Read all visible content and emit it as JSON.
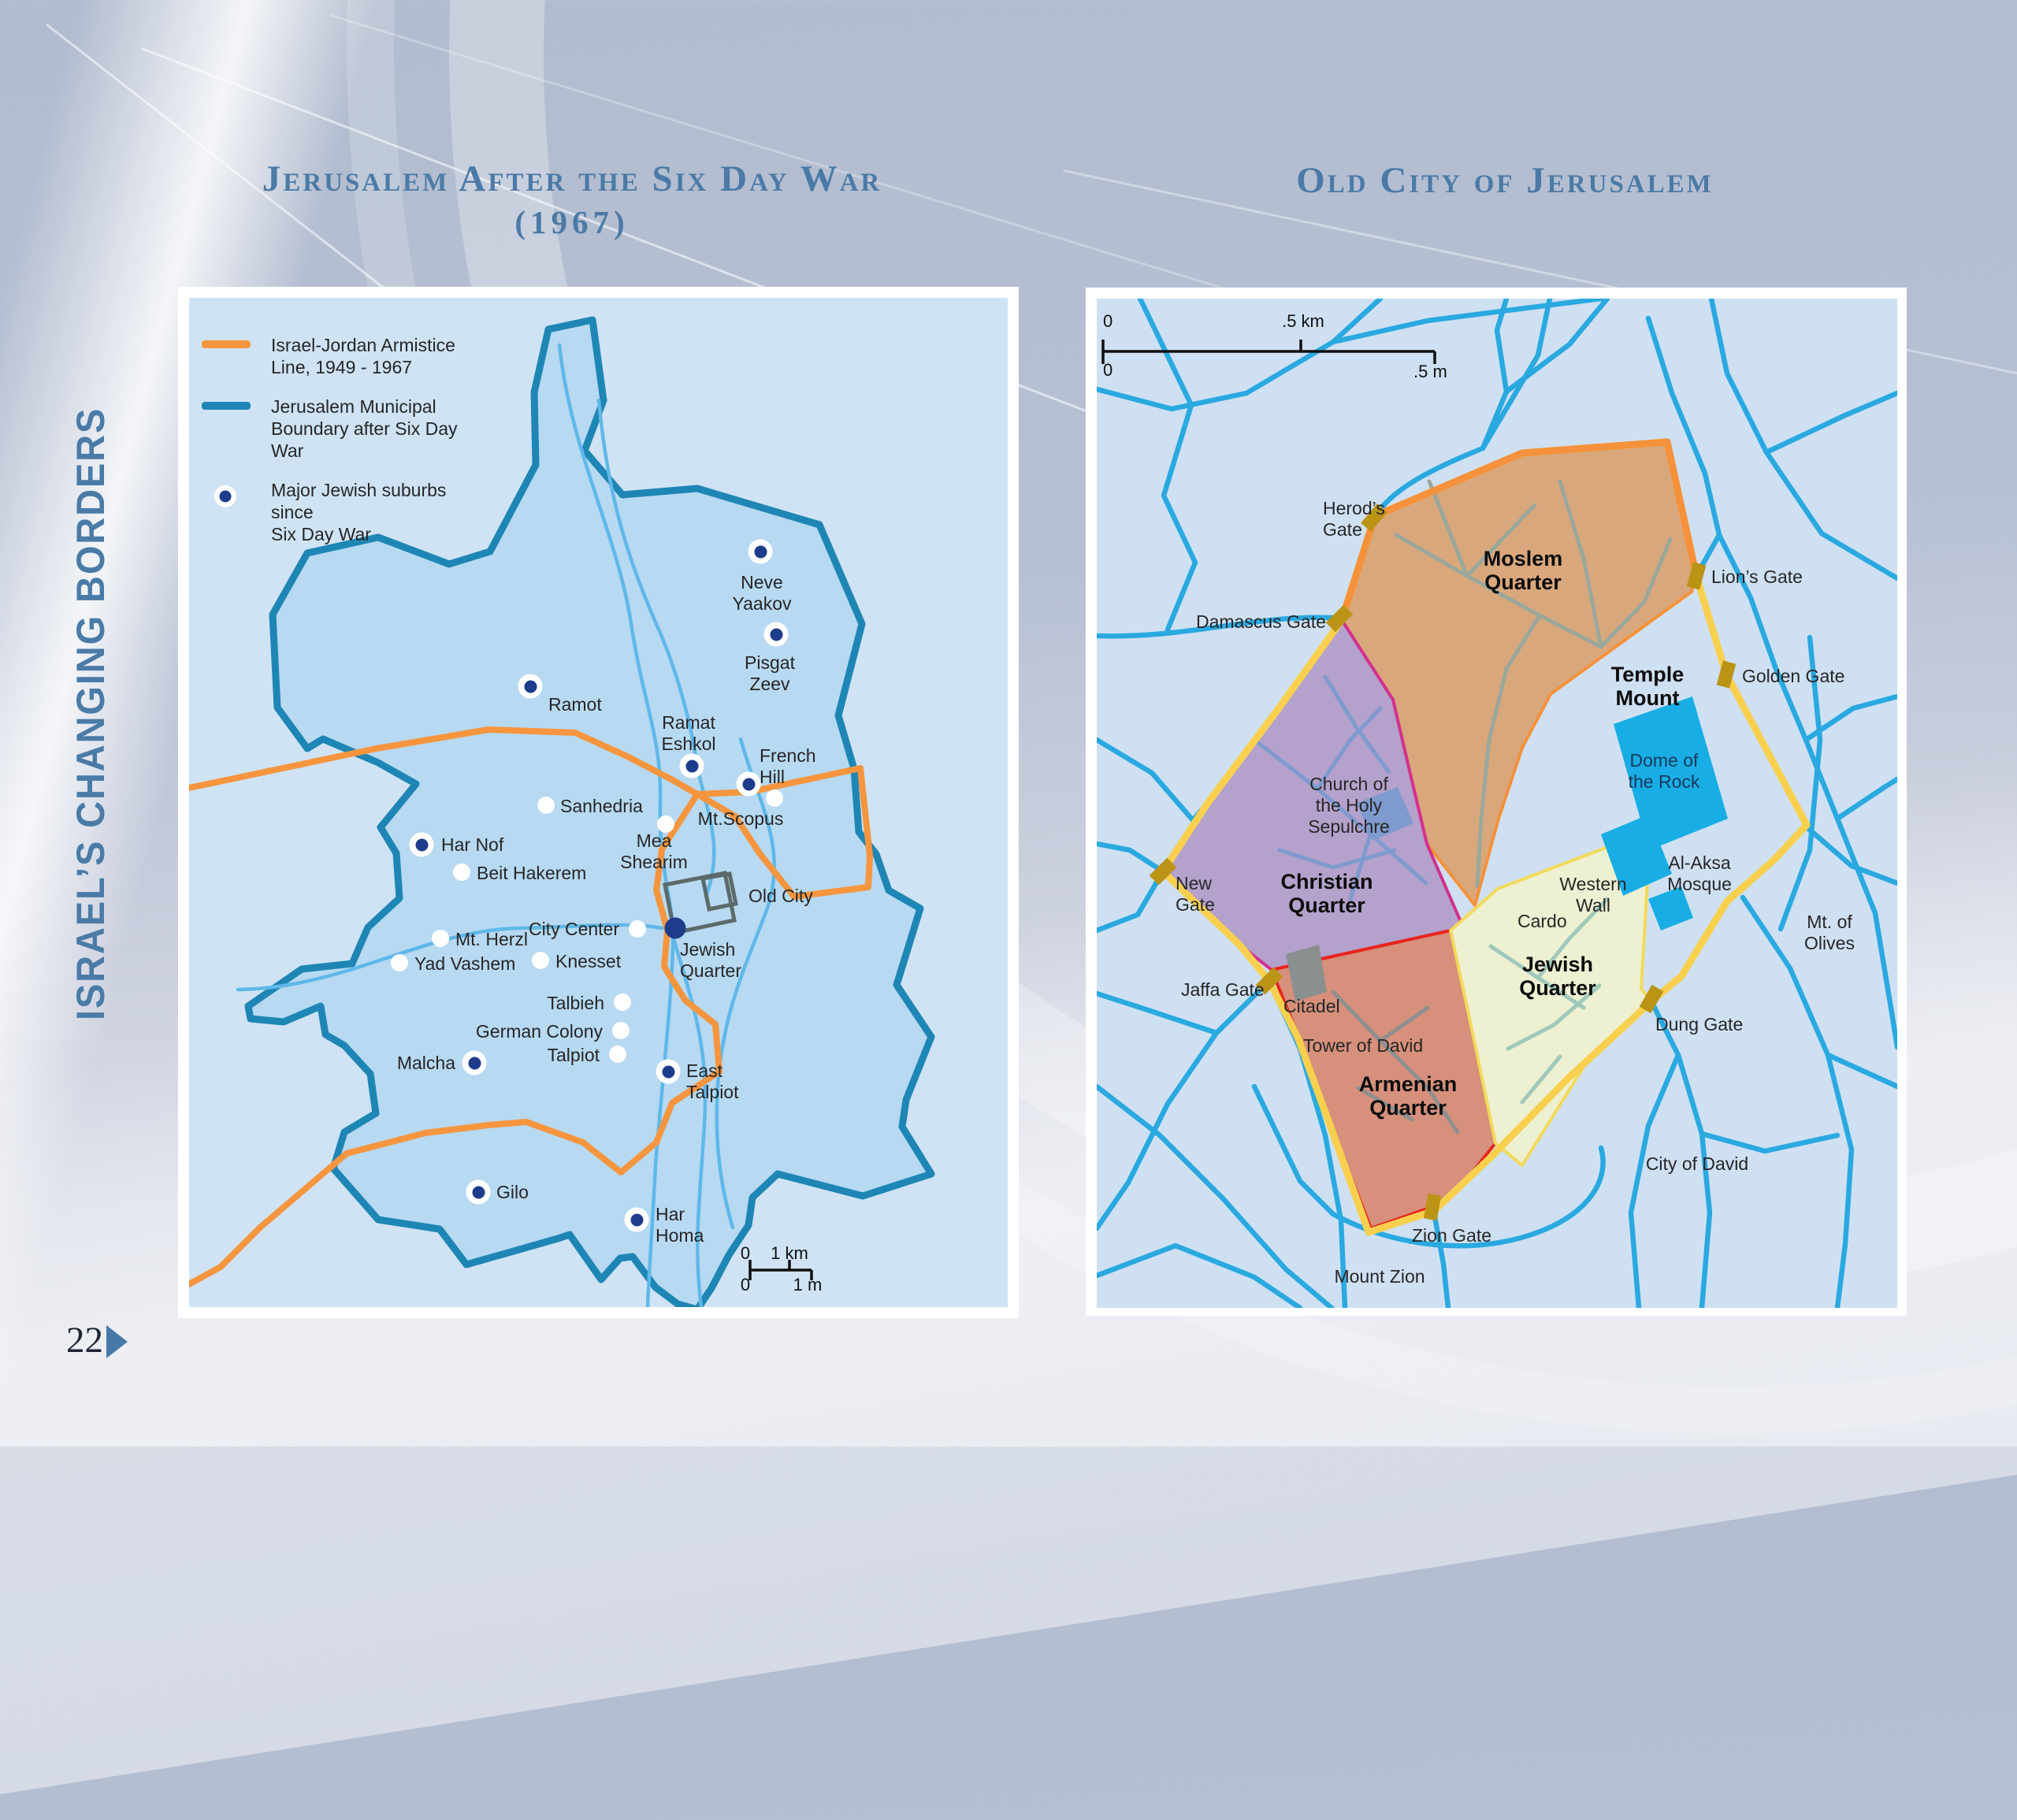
{
  "page": {
    "sidebar_title": "ISRAEL’S CHANGING BORDERS",
    "page_number": "22"
  },
  "left_map": {
    "title_line1": "Jerusalem After the Six Day War",
    "title_line2": "(1967)",
    "legend": [
      {
        "symbol": "orange-line",
        "line1": "Israel-Jordan Armistice",
        "line2": "Line, 1949 - 1967"
      },
      {
        "symbol": "teal-line",
        "line1": "Jerusalem Municipal",
        "line2": "Boundary after Six Day War"
      },
      {
        "symbol": "suburb-dot",
        "line1": "Major Jewish suburbs since",
        "line2": "Six Day War"
      }
    ],
    "scale": {
      "zero_top": "0",
      "top_unit": "1 km",
      "zero_bottom": "0",
      "bottom_unit": "1 m"
    },
    "points": [
      {
        "id": "neve-yaakov",
        "t": "suburb",
        "dot": [
          725,
          322
        ],
        "label": [
          727,
          348
        ],
        "align": "center",
        "lines": [
          "Neve",
          "Yaakov"
        ]
      },
      {
        "id": "pisgat-zeev",
        "t": "suburb",
        "dot": [
          745,
          427
        ],
        "label": [
          737,
          450
        ],
        "align": "center",
        "lines": [
          "Pisgat",
          "Zeev"
        ]
      },
      {
        "id": "ramot",
        "t": "suburb",
        "dot": [
          433,
          493
        ],
        "label": [
          456,
          503
        ],
        "align": "left",
        "lines": [
          "Ramot"
        ]
      },
      {
        "id": "ramat-eshkol",
        "t": "suburb",
        "dot": [
          638,
          594
        ],
        "label": [
          634,
          526
        ],
        "align": "center",
        "lines": [
          "Ramat",
          "Eshkol"
        ]
      },
      {
        "id": "french-hill",
        "t": "suburb",
        "dot": [
          710,
          617
        ],
        "label": [
          724,
          568
        ],
        "align": "left",
        "lines": [
          "French",
          "Hill"
        ]
      },
      {
        "id": "har-nof",
        "t": "suburb",
        "dot": [
          295,
          694
        ],
        "label": [
          320,
          681
        ],
        "align": "left",
        "lines": [
          "Har Nof"
        ]
      },
      {
        "id": "malcha",
        "t": "suburb",
        "dot": [
          362,
          971
        ],
        "label": [
          338,
          958
        ],
        "align": "right",
        "lines": [
          "Malcha"
        ]
      },
      {
        "id": "east-talpiot",
        "t": "suburb",
        "dot": [
          608,
          982
        ],
        "label": [
          631,
          968
        ],
        "align": "left",
        "lines": [
          "East",
          "Talpiot"
        ]
      },
      {
        "id": "gilo",
        "t": "suburb",
        "dot": [
          367,
          1135
        ],
        "label": [
          390,
          1122
        ],
        "align": "left",
        "lines": [
          "Gilo"
        ]
      },
      {
        "id": "har-homa",
        "t": "suburb",
        "dot": [
          568,
          1170
        ],
        "label": [
          592,
          1150
        ],
        "align": "left",
        "lines": [
          "Har",
          "Homa"
        ]
      },
      {
        "id": "jewish-quarter-left",
        "t": "navy",
        "dot": [
          617,
          800
        ],
        "label": [
          623,
          814
        ],
        "align": "left",
        "lines": [
          "Jewish",
          "Quarter"
        ]
      },
      {
        "id": "sanhedria",
        "t": "poi",
        "dot": [
          453,
          644
        ],
        "label": [
          471,
          632
        ],
        "align": "left",
        "lines": [
          "Sanhedria"
        ]
      },
      {
        "id": "mea-shearim",
        "t": "poi",
        "dot": [
          605,
          668
        ],
        "label": [
          590,
          676
        ],
        "align": "center",
        "lines": [
          "Mea",
          "Shearim"
        ]
      },
      {
        "id": "mt-scopus",
        "t": "poi",
        "dot": [
          743,
          635
        ],
        "label": [
          700,
          648
        ],
        "align": "center",
        "lines": [
          "Mt.Scopus"
        ]
      },
      {
        "id": "beit-hakerem",
        "t": "poi",
        "dot": [
          346,
          729
        ],
        "label": [
          365,
          717
        ],
        "align": "left",
        "lines": [
          "Beit Hakerem"
        ]
      },
      {
        "id": "city-center",
        "t": "poi",
        "dot": [
          569,
          801
        ],
        "label": [
          546,
          788
        ],
        "align": "right",
        "lines": [
          "City Center"
        ]
      },
      {
        "id": "mt-herzl",
        "t": "poi",
        "dot": [
          319,
          813
        ],
        "label": [
          338,
          801
        ],
        "align": "left",
        "lines": [
          "Mt. Herzl"
        ]
      },
      {
        "id": "yad-vashem",
        "t": "poi",
        "dot": [
          267,
          844
        ],
        "label": [
          286,
          832
        ],
        "align": "left",
        "lines": [
          "Yad Vashem"
        ]
      },
      {
        "id": "knesset",
        "t": "poi",
        "dot": [
          446,
          841
        ],
        "label": [
          465,
          829
        ],
        "align": "left",
        "lines": [
          "Knesset"
        ]
      },
      {
        "id": "talbieh",
        "t": "poi",
        "dot": [
          550,
          894
        ],
        "label": [
          527,
          882
        ],
        "align": "right",
        "lines": [
          "Talbieh"
        ]
      },
      {
        "id": "german-colony",
        "t": "poi",
        "dot": [
          548,
          930
        ],
        "label": [
          525,
          918
        ],
        "align": "right",
        "lines": [
          "German Colony"
        ]
      },
      {
        "id": "talpiot",
        "t": "poi",
        "dot": [
          544,
          960
        ],
        "label": [
          521,
          948
        ],
        "align": "right",
        "lines": [
          "Talpiot"
        ]
      },
      {
        "id": "old-city",
        "t": "plain",
        "label": [
          710,
          746
        ],
        "align": "left",
        "lines": [
          "Old City"
        ]
      },
      {
        "id": "scale-zero-km",
        "t": "plain",
        "cls": "scale",
        "label": [
          706,
          1200
        ],
        "align": "center",
        "lines": [
          "0"
        ]
      },
      {
        "id": "scale-1km",
        "t": "plain",
        "cls": "scale",
        "label": [
          762,
          1200
        ],
        "align": "center",
        "lines": [
          "1 km"
        ]
      },
      {
        "id": "scale-zero-m",
        "t": "plain",
        "cls": "scale",
        "label": [
          706,
          1240
        ],
        "align": "center",
        "lines": [
          "0"
        ]
      },
      {
        "id": "scale-1m",
        "t": "plain",
        "cls": "scale",
        "label": [
          785,
          1240
        ],
        "align": "center",
        "lines": [
          "1 m"
        ]
      }
    ]
  },
  "right_map": {
    "title": "Old City of Jerusalem",
    "scale": {
      "zero_top": "0",
      "top_unit": ".5 km",
      "zero_bottom": "0",
      "bottom_unit": ".5 m"
    },
    "points": [
      {
        "id": "herods-gate",
        "t": "gate",
        "marker": [
          352,
          278,
          40
        ],
        "label": [
          287,
          253
        ],
        "align": "left",
        "lines": [
          "Herod’s",
          "Gate"
        ]
      },
      {
        "id": "damascus-gate",
        "t": "gate",
        "marker": [
          308,
          406,
          45
        ],
        "label": [
          126,
          397
        ],
        "align": "left",
        "lines": [
          "Damascus Gate"
        ]
      },
      {
        "id": "lions-gate",
        "t": "gate",
        "marker": [
          761,
          352,
          15
        ],
        "label": [
          780,
          340
        ],
        "align": "left",
        "lines": [
          "Lion’s Gate"
        ]
      },
      {
        "id": "golden-gate",
        "t": "gate",
        "marker": [
          799,
          477,
          15
        ],
        "label": [
          819,
          466
        ],
        "align": "left",
        "lines": [
          "Golden Gate"
        ]
      },
      {
        "id": "new-gate",
        "t": "gate",
        "marker": [
          84,
          727,
          45
        ],
        "label": [
          100,
          729
        ],
        "align": "left",
        "lines": [
          "New",
          "Gate"
        ]
      },
      {
        "id": "jaffa-gate",
        "t": "gate",
        "marker": [
          219,
          866,
          45
        ],
        "label": [
          107,
          864
        ],
        "align": "left",
        "lines": [
          "Jaffa Gate"
        ]
      },
      {
        "id": "zion-gate",
        "t": "gate",
        "marker": [
          426,
          1153,
          10
        ],
        "label": [
          400,
          1176
        ],
        "align": "left",
        "lines": [
          "Zion Gate"
        ]
      },
      {
        "id": "dung-gate",
        "t": "gate",
        "marker": [
          704,
          889,
          30
        ],
        "label": [
          709,
          908
        ],
        "align": "left",
        "lines": [
          "Dung Gate"
        ]
      },
      {
        "id": "moslem-quarter",
        "t": "plain",
        "cls": "quarter",
        "label": [
          541,
          315
        ],
        "align": "center",
        "lines": [
          "Moslem",
          "Quarter"
        ]
      },
      {
        "id": "christian-quarter",
        "t": "plain",
        "cls": "quarter",
        "label": [
          292,
          725
        ],
        "align": "center",
        "lines": [
          "Christian",
          "Quarter"
        ]
      },
      {
        "id": "armenian-quarter",
        "t": "plain",
        "cls": "quarter",
        "label": [
          395,
          982
        ],
        "align": "center",
        "lines": [
          "Armenian",
          "Quarter"
        ]
      },
      {
        "id": "jewish-quarter",
        "t": "plain",
        "cls": "quarter",
        "label": [
          585,
          830
        ],
        "align": "center",
        "lines": [
          "Jewish",
          "Quarter"
        ]
      },
      {
        "id": "temple-mount",
        "t": "plain",
        "cls": "quarter",
        "label": [
          699,
          462
        ],
        "align": "center",
        "lines": [
          "Temple",
          "Mount"
        ]
      },
      {
        "id": "church-holy-sepulchre",
        "t": "plain",
        "label": [
          320,
          603
        ],
        "align": "center",
        "lines": [
          "Church of",
          "the Holy",
          "Sepulchre"
        ]
      },
      {
        "id": "dome-of-the-rock",
        "t": "plain",
        "cls": "dome",
        "label": [
          720,
          573
        ],
        "align": "center",
        "lines": [
          "Dome of",
          "the Rock"
        ]
      },
      {
        "id": "al-aksa-mosque",
        "t": "plain",
        "label": [
          765,
          703
        ],
        "align": "center",
        "lines": [
          "Al-Aksa",
          "Mosque"
        ]
      },
      {
        "id": "western-wall",
        "t": "plain",
        "label": [
          630,
          730
        ],
        "align": "center",
        "lines": [
          "Western",
          "Wall"
        ]
      },
      {
        "id": "cardo",
        "t": "plain",
        "label": [
          534,
          777
        ],
        "align": "left",
        "lines": [
          "Cardo"
        ]
      },
      {
        "id": "citadel",
        "t": "plain",
        "label": [
          237,
          885
        ],
        "align": "left",
        "lines": [
          "Citadel"
        ]
      },
      {
        "id": "tower-of-david",
        "t": "plain",
        "label": [
          262,
          935
        ],
        "align": "left",
        "lines": [
          "Tower of David"
        ]
      },
      {
        "id": "mount-zion",
        "t": "plain",
        "label": [
          359,
          1228
        ],
        "align": "center",
        "lines": [
          "Mount Zion"
        ]
      },
      {
        "id": "city-of-david",
        "t": "plain",
        "label": [
          762,
          1085
        ],
        "align": "center",
        "lines": [
          "City of David"
        ]
      },
      {
        "id": "mt-of-olives",
        "t": "plain",
        "label": [
          930,
          778
        ],
        "align": "center",
        "lines": [
          "Mt. of",
          "Olives"
        ]
      },
      {
        "id": "rscale-zero-km",
        "t": "plain",
        "cls": "scale",
        "label": [
          8,
          16
        ],
        "align": "left",
        "lines": [
          "0"
        ]
      },
      {
        "id": "rscale-half-km",
        "t": "plain",
        "cls": "scale",
        "label": [
          262,
          16
        ],
        "align": "center",
        "lines": [
          ".5 km"
        ]
      },
      {
        "id": "rscale-zero-m",
        "t": "plain",
        "cls": "scale",
        "label": [
          8,
          78
        ],
        "align": "left",
        "lines": [
          "0"
        ]
      },
      {
        "id": "rscale-half-m",
        "t": "plain",
        "cls": "scale",
        "label": [
          402,
          80
        ],
        "align": "left",
        "lines": [
          ".5 m"
        ]
      }
    ],
    "colors": {
      "moslem_fill": "#d9a77c",
      "moslem_border": "#f5913a",
      "christian_fill": "#b4a1cc",
      "christian_border": "#d2318e",
      "armenian_fill": "#d6907b",
      "armenian_border": "#e8251d",
      "jewish_fill": "#eef0d2",
      "jewish_border": "#f2da5a",
      "wall_yellow": "#f8d04e",
      "street_blue": "#2aa9e1",
      "mosque_cyan": "#18aee5",
      "gate": "#bb9416"
    }
  }
}
